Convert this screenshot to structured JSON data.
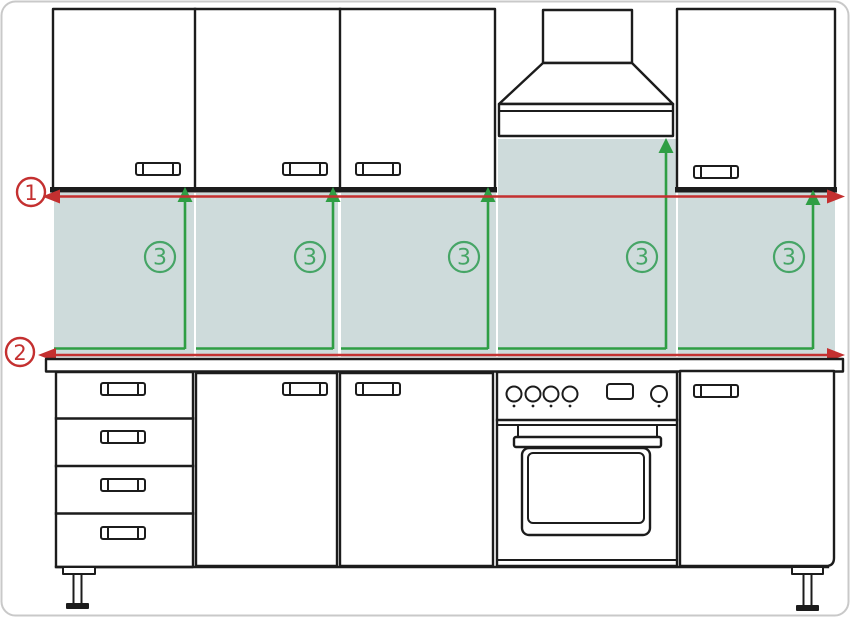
{
  "diagram": {
    "markers": {
      "line1_label": "1",
      "line2_label": "2",
      "height_label": "3",
      "height_marker_count": 5
    },
    "colors": {
      "outline": "#1c1c1c",
      "dimension_red": "#c43030",
      "height_green": "#2f9e44",
      "circle_green": "#46a566",
      "backsplash_fill": "#cedbdb",
      "border_gray": "#c9c9c9"
    }
  }
}
